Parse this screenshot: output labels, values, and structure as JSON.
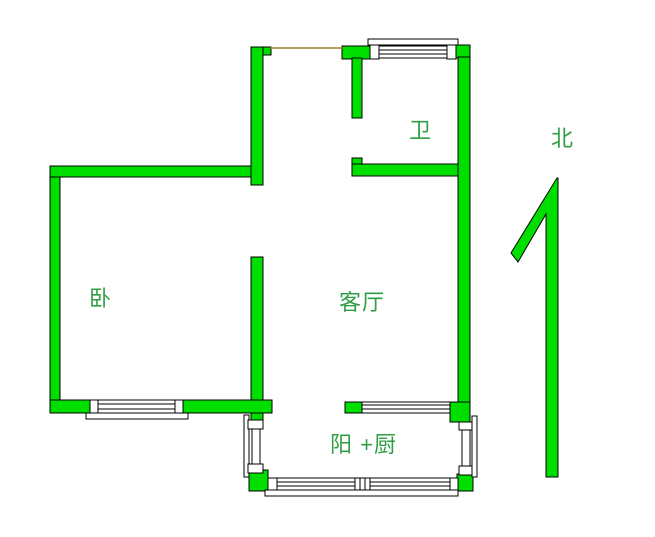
{
  "title": "apartment-floor-plan",
  "labels": {
    "bedroom": "卧",
    "living_room": "客厅",
    "bathroom": "卫",
    "balcony_kitchen": "阳 +厨",
    "north": "北"
  },
  "icons": {
    "north_arrow": "north-arrow-icon"
  },
  "colors": {
    "wall": "#00de00",
    "wall_outline": "#000000",
    "label_text": "#2f9e44",
    "door_line": "#9a7d2f",
    "background": "#ffffff"
  }
}
